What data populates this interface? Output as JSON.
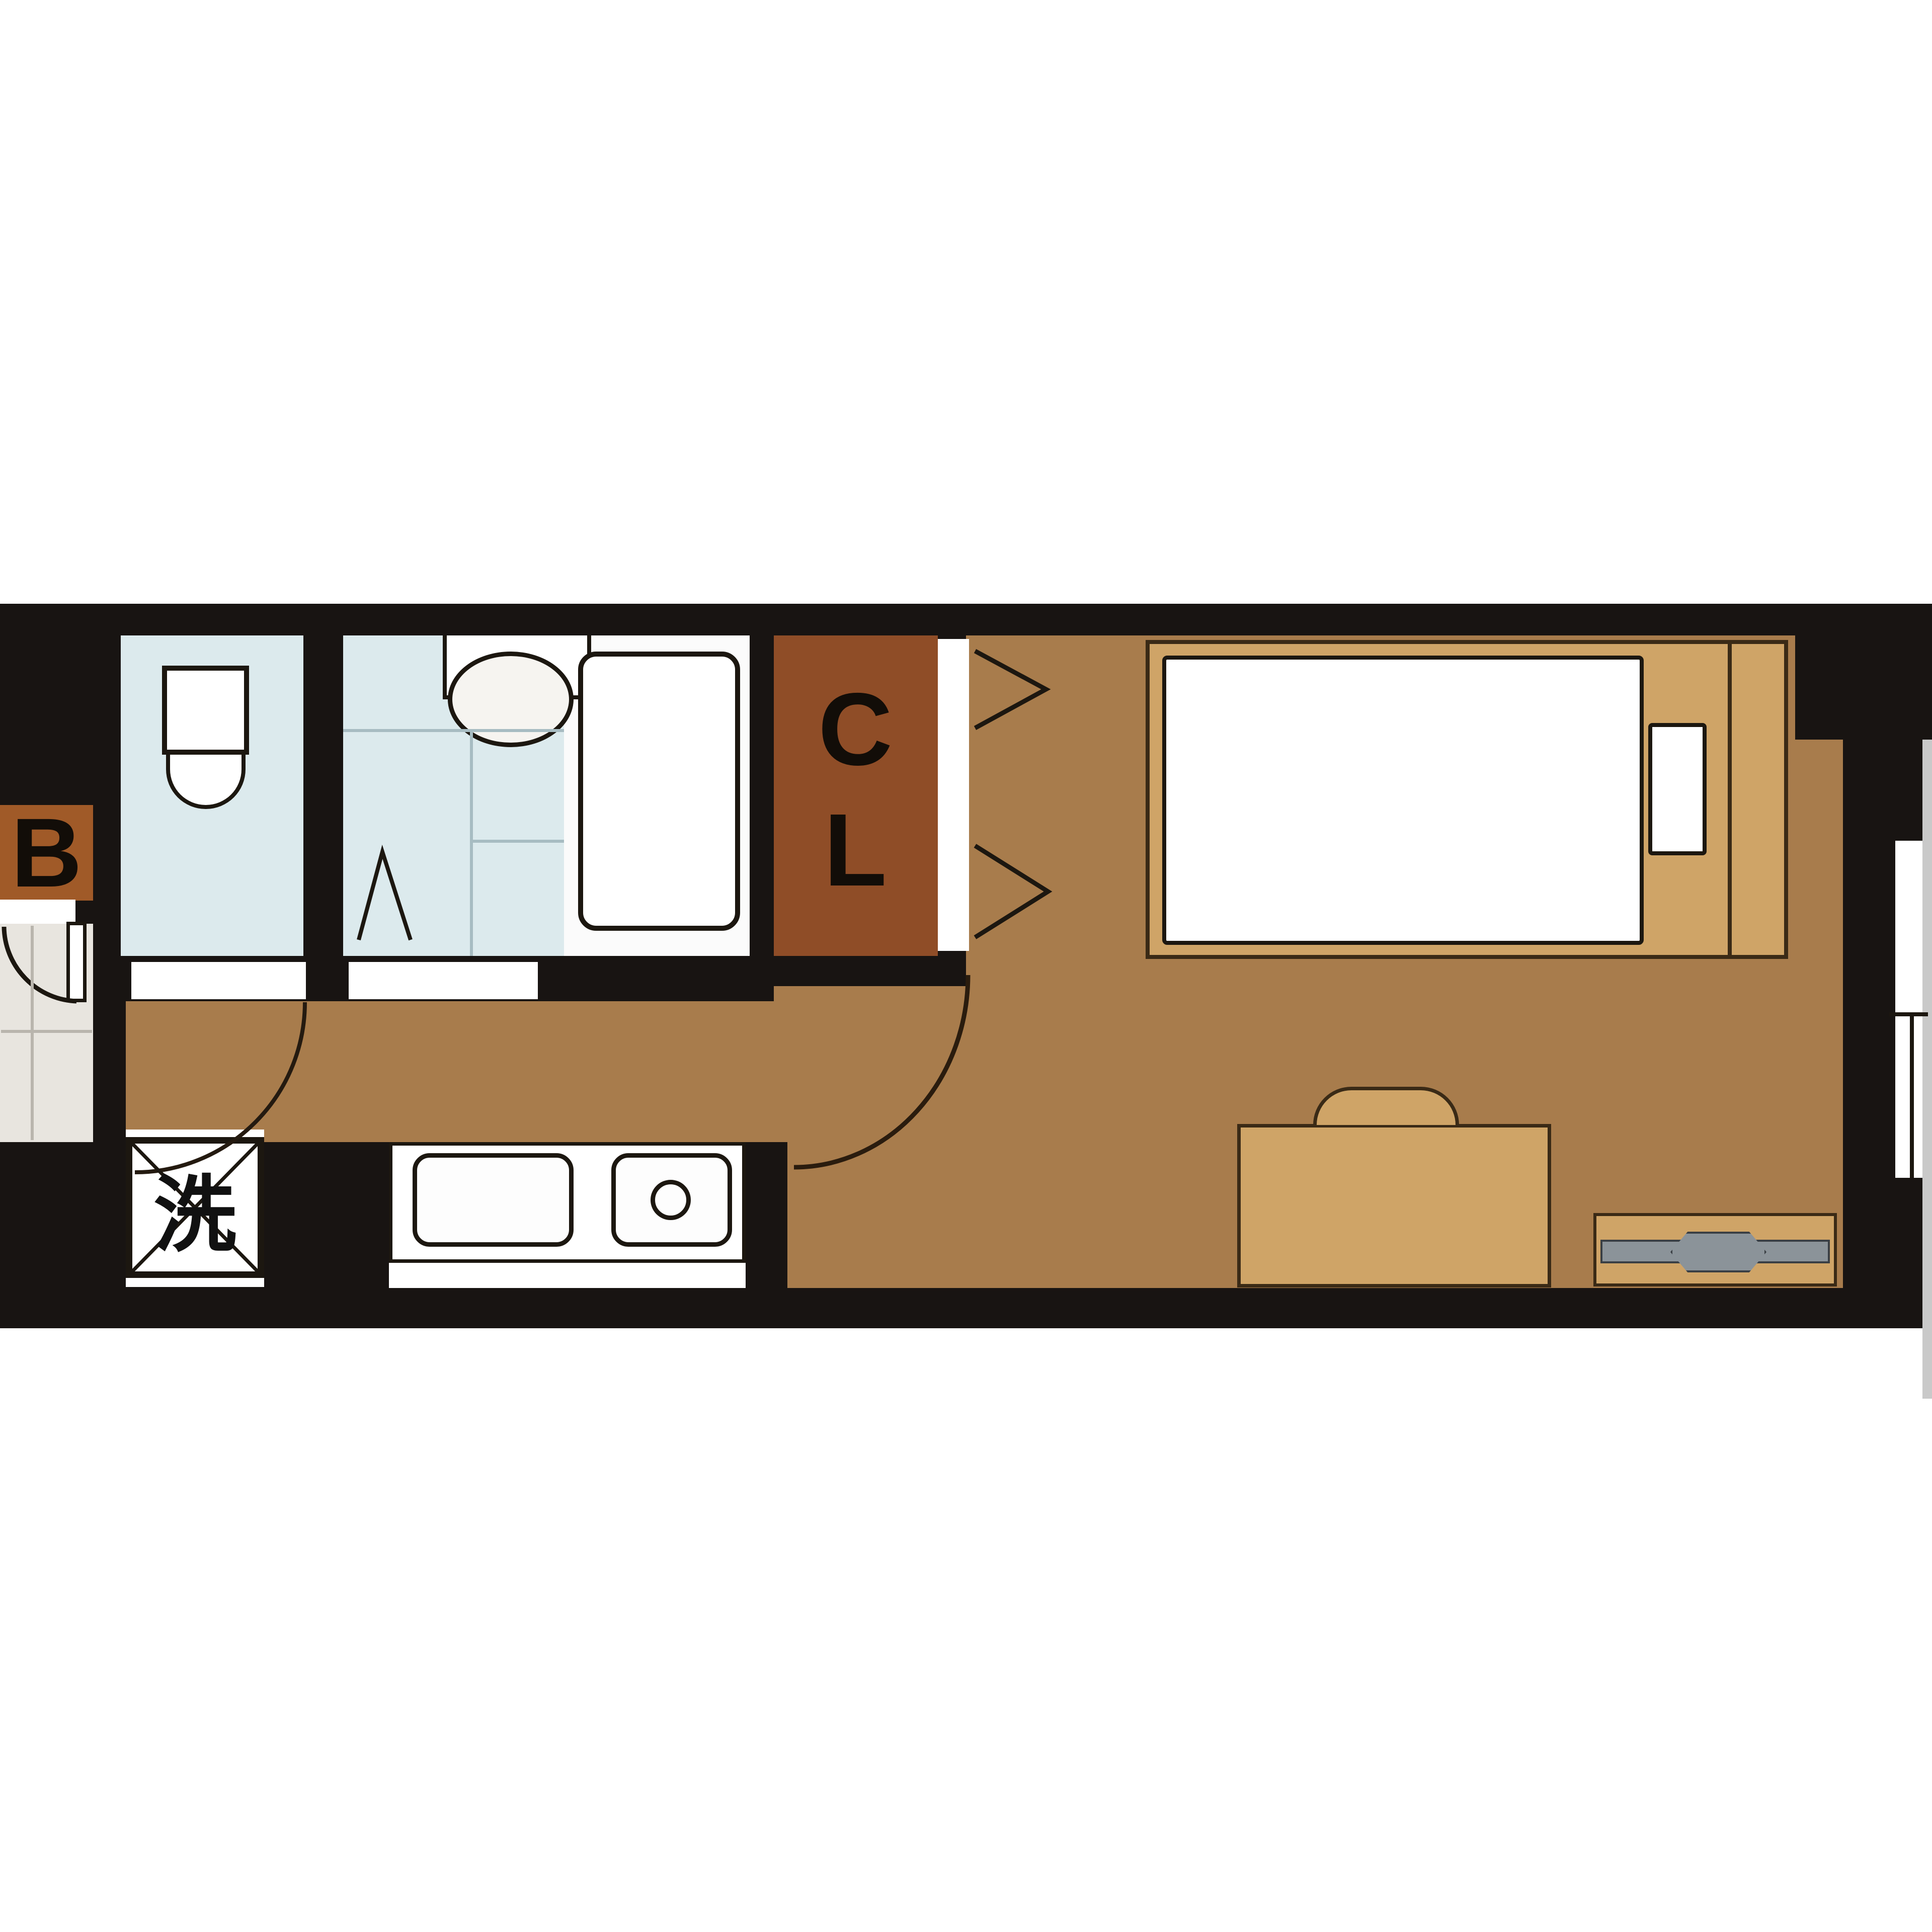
{
  "title": "Studio apartment floor plan",
  "labels": {
    "balcony": "B",
    "closet_line1": "C",
    "closet_line2": "L",
    "laundry": "洗"
  },
  "colors": {
    "wall_black": "#181412",
    "floor_brown": "#a87c4c",
    "furniture_tan": "#cfa467",
    "closet_rust": "#8f4d27",
    "balcony_rust": "#a05a28",
    "wet_room_blue": "#dceaed",
    "entrance_grey": "#e8e5df",
    "outside_grey": "#c9c9c9",
    "tv_grey": "#8b9399",
    "line_black": "#1c1710",
    "white": "#ffffff"
  }
}
